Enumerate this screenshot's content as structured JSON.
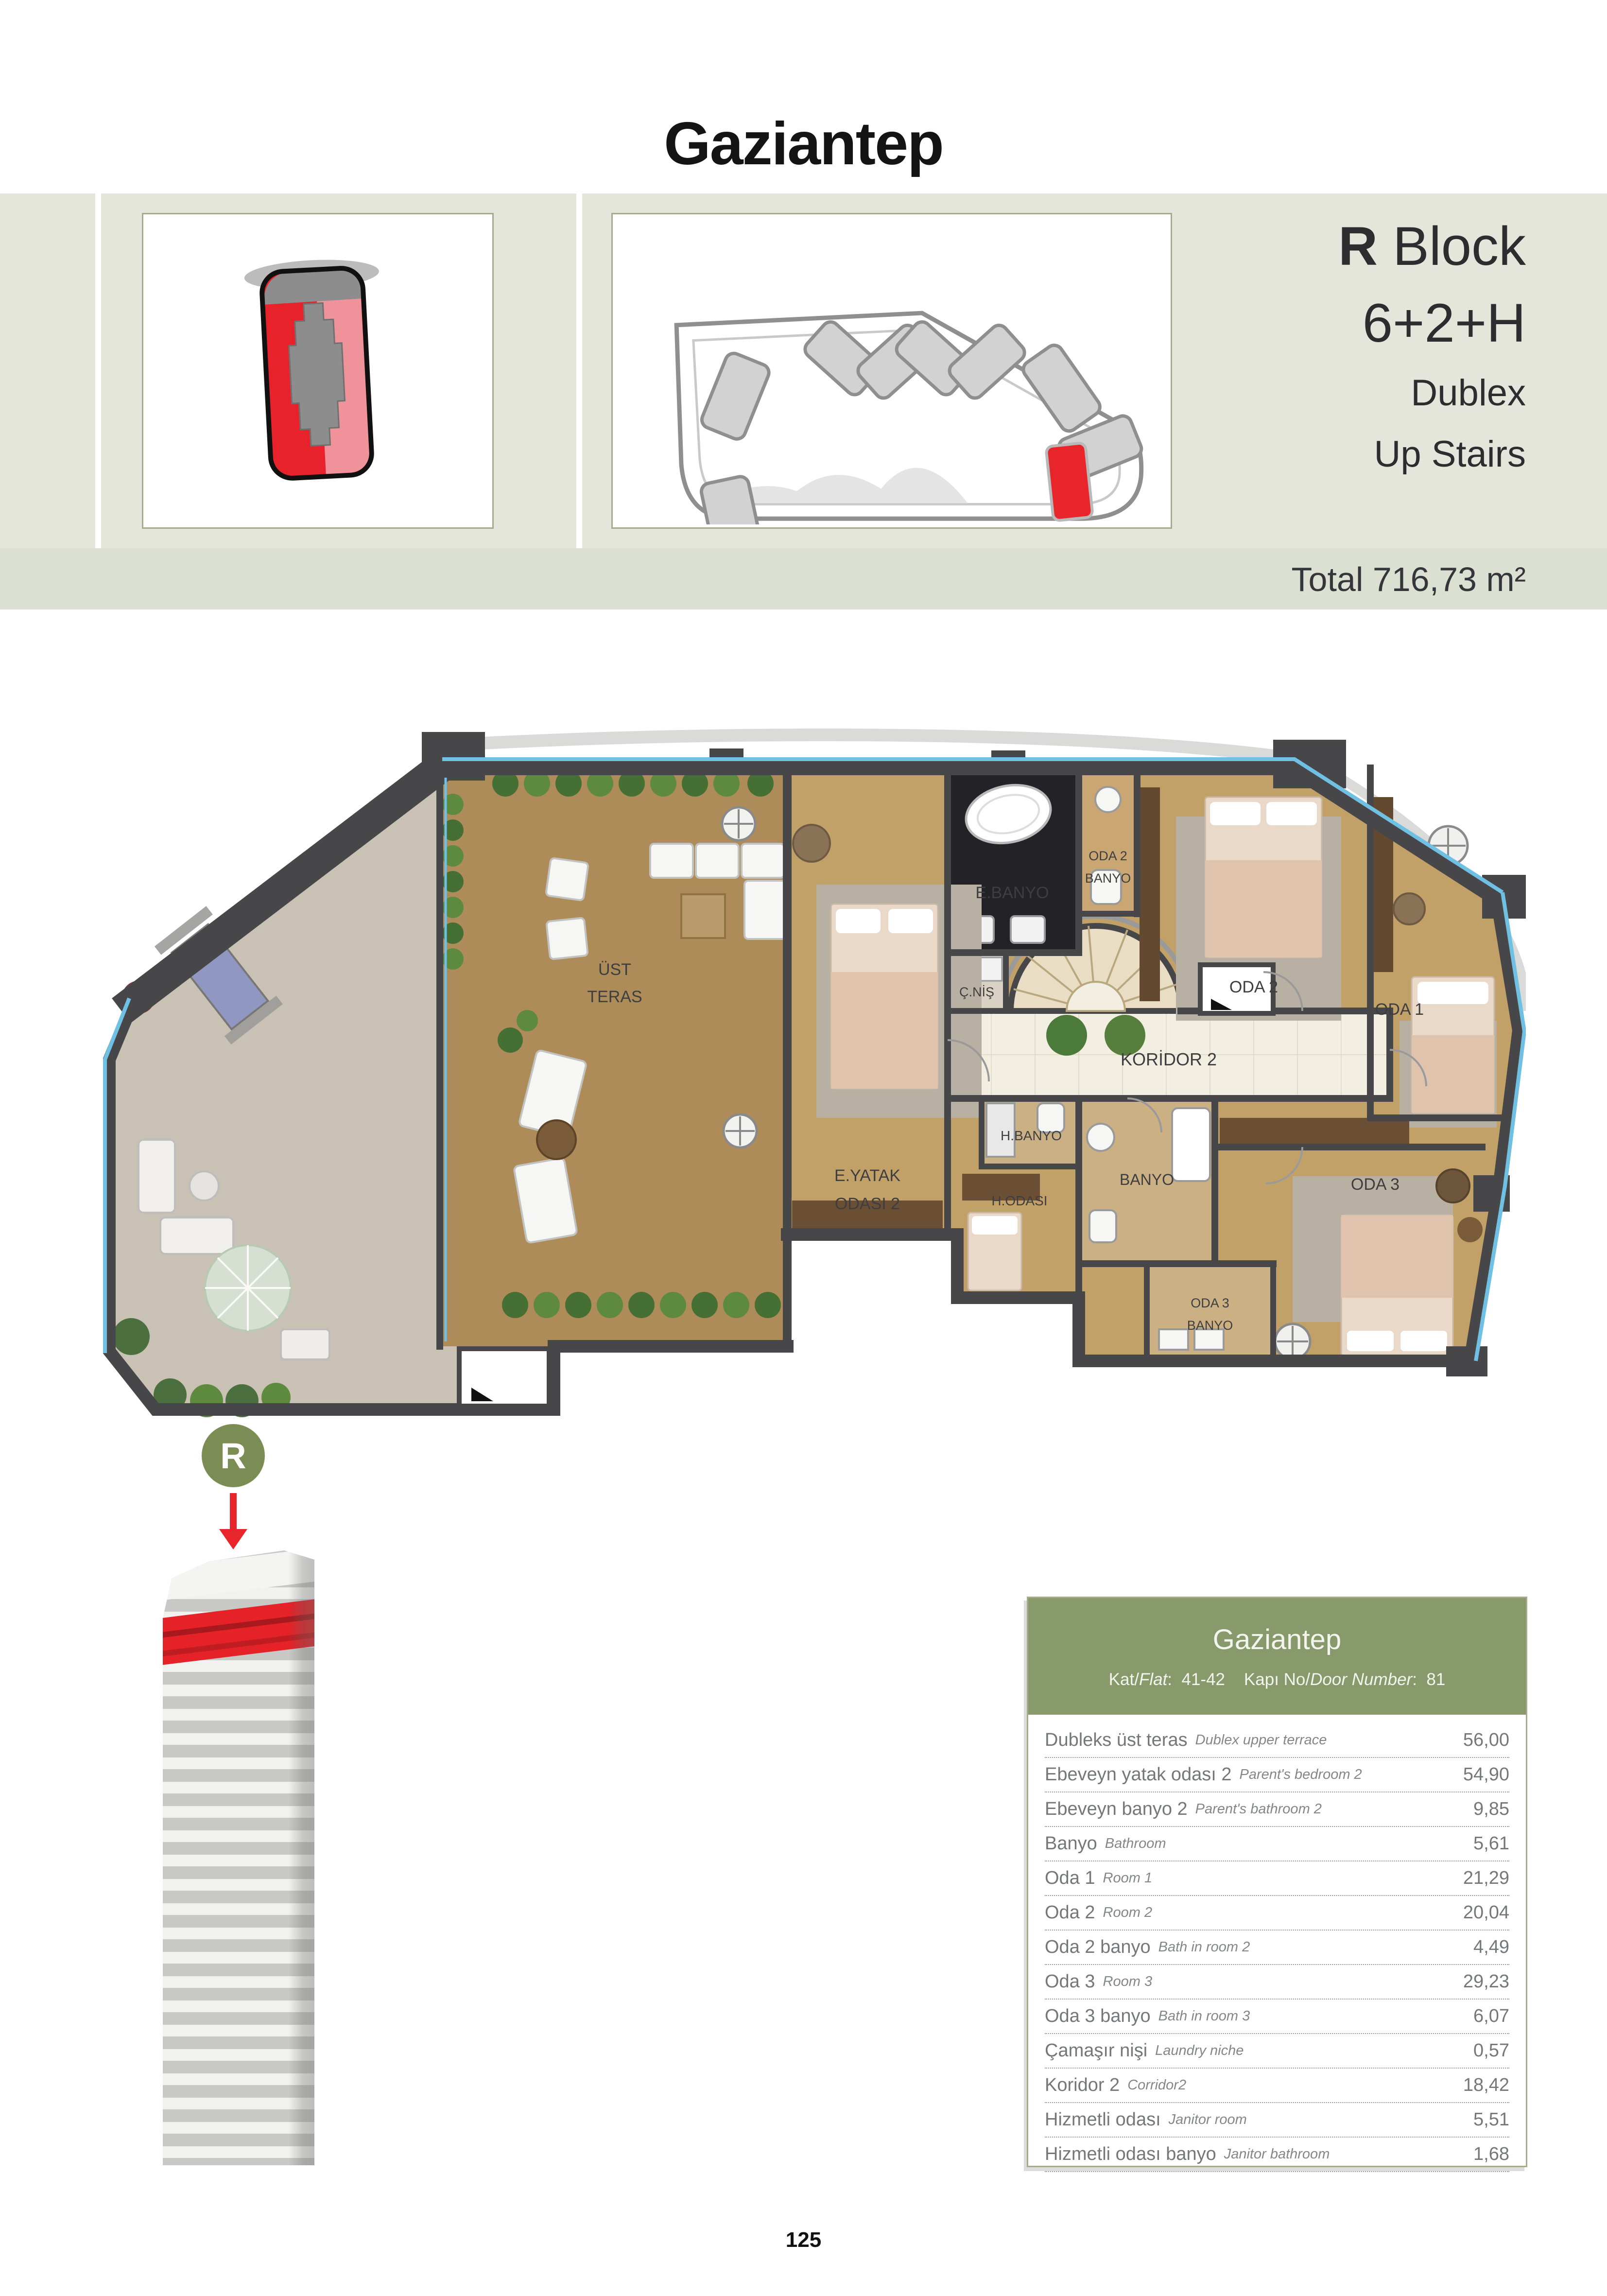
{
  "page": {
    "title": "Gaziantep",
    "page_number": "125"
  },
  "header": {
    "block_letter": "R",
    "block_word": " Block",
    "layout": "6+2+H",
    "type": "Dublex",
    "level": "Up Stairs",
    "total": "Total 716,73 m²"
  },
  "floor_plan": {
    "labels": {
      "ust_1": "ÜST",
      "ust_2": "TERAS",
      "eyatak_1": "E.YATAK",
      "eyatak_2": "ODASI 2",
      "ebanyo": "E.BANYO",
      "oda2banyo_1": "ODA 2",
      "oda2banyo_2": "BANYO",
      "cnis": "Ç.NİŞ",
      "oda2": "ODA 2",
      "oda1": "ODA 1",
      "koridor2": "KORİDOR 2",
      "hbanyo": "H.BANYO",
      "hodasi": "H.ODASI",
      "banyo": "BANYO",
      "oda3": "ODA 3",
      "oda3banyo_1": "ODA 3",
      "oda3banyo_2": "BANYO"
    }
  },
  "tower": {
    "badge": "R"
  },
  "info_card": {
    "title": "Gaziantep",
    "kat_label": "Kat/",
    "kat_label_en": "Flat",
    "kat_colon": ":",
    "kat_value": "41-42",
    "kapi_label": "Kapı No/",
    "kapi_label_en": "Door Number",
    "kapi_colon": ":",
    "kapi_value": "81",
    "rows": [
      {
        "tr": "Dubleks üst teras",
        "en": "Dublex upper terrace",
        "value": "56,00"
      },
      {
        "tr": "Ebeveyn yatak odası 2",
        "en": "Parent's bedroom 2",
        "value": "54,90"
      },
      {
        "tr": "Ebeveyn banyo 2",
        "en": "Parent's bathroom 2",
        "value": "9,85"
      },
      {
        "tr": "Banyo",
        "en": "Bathroom",
        "value": "5,61"
      },
      {
        "tr": "Oda 1",
        "en": "Room 1",
        "value": "21,29"
      },
      {
        "tr": "Oda 2",
        "en": "Room 2",
        "value": "20,04"
      },
      {
        "tr": "Oda 2 banyo",
        "en": "Bath in room 2",
        "value": "4,49"
      },
      {
        "tr": "Oda 3",
        "en": "Room 3",
        "value": "29,23"
      },
      {
        "tr": "Oda 3 banyo",
        "en": "Bath in room 3",
        "value": "6,07"
      },
      {
        "tr": "Çamaşır nişi",
        "en": "Laundry niche",
        "value": "0,57"
      },
      {
        "tr": "Koridor 2",
        "en": "Corridor2",
        "value": "18,42"
      },
      {
        "tr": "Hizmetli odası",
        "en": "Janitor room",
        "value": "5,51"
      },
      {
        "tr": "Hizmetli odası banyo",
        "en": "Janitor bathroom",
        "value": "1,68"
      }
    ]
  }
}
